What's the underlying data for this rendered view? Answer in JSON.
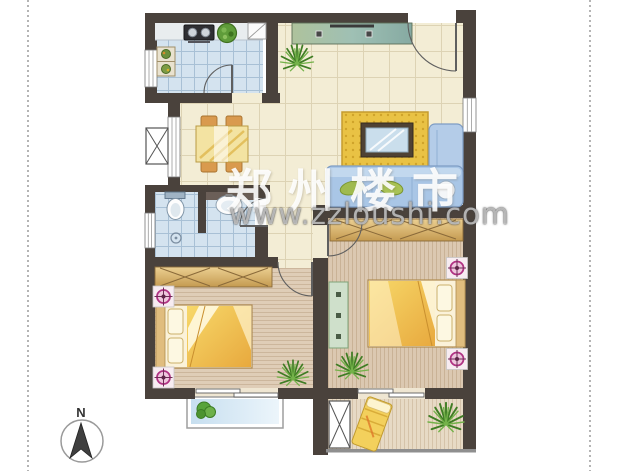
{
  "page": {
    "background": "#ffffff",
    "border_dots_color": "#b4b4b4"
  },
  "watermark": {
    "brand": "郑州楼市",
    "url": "www.zzloushi.com"
  },
  "compass": {
    "label": "N"
  },
  "palette": {
    "wall": "#4a423c",
    "tile_blue": "#d4e3ef",
    "tile_cream": "#f3edd5",
    "wood_light": "#dfcdb7",
    "bed_yellow": "#f0c24e",
    "sofa_blue": "#a9c6e6",
    "rug_yellow": "#e9c244",
    "plant_green": "#4e8c2c",
    "stool_magenta": "#b03283",
    "balcony_sky": "#cfe4f2"
  },
  "icons": [
    "stove-icon",
    "vegetable-basket-icon",
    "corner-shelf-icon",
    "kitchen-cabinet-icon",
    "dining-table-icon",
    "dining-chair-icon",
    "toilet-icon",
    "sink-icon",
    "shower-icon",
    "elevator-shaft-icon",
    "shaft-icon",
    "sideboard-icon",
    "rug-icon",
    "mirror-table-icon",
    "sofa-icon",
    "wardrobe-icon",
    "double-bed-icon",
    "bedside-stool-icon",
    "dresser-icon",
    "plant-icon",
    "bush-icon",
    "lounge-chair-icon",
    "sliding-door-icon",
    "swing-door-icon",
    "window-icon",
    "compass-icon"
  ]
}
